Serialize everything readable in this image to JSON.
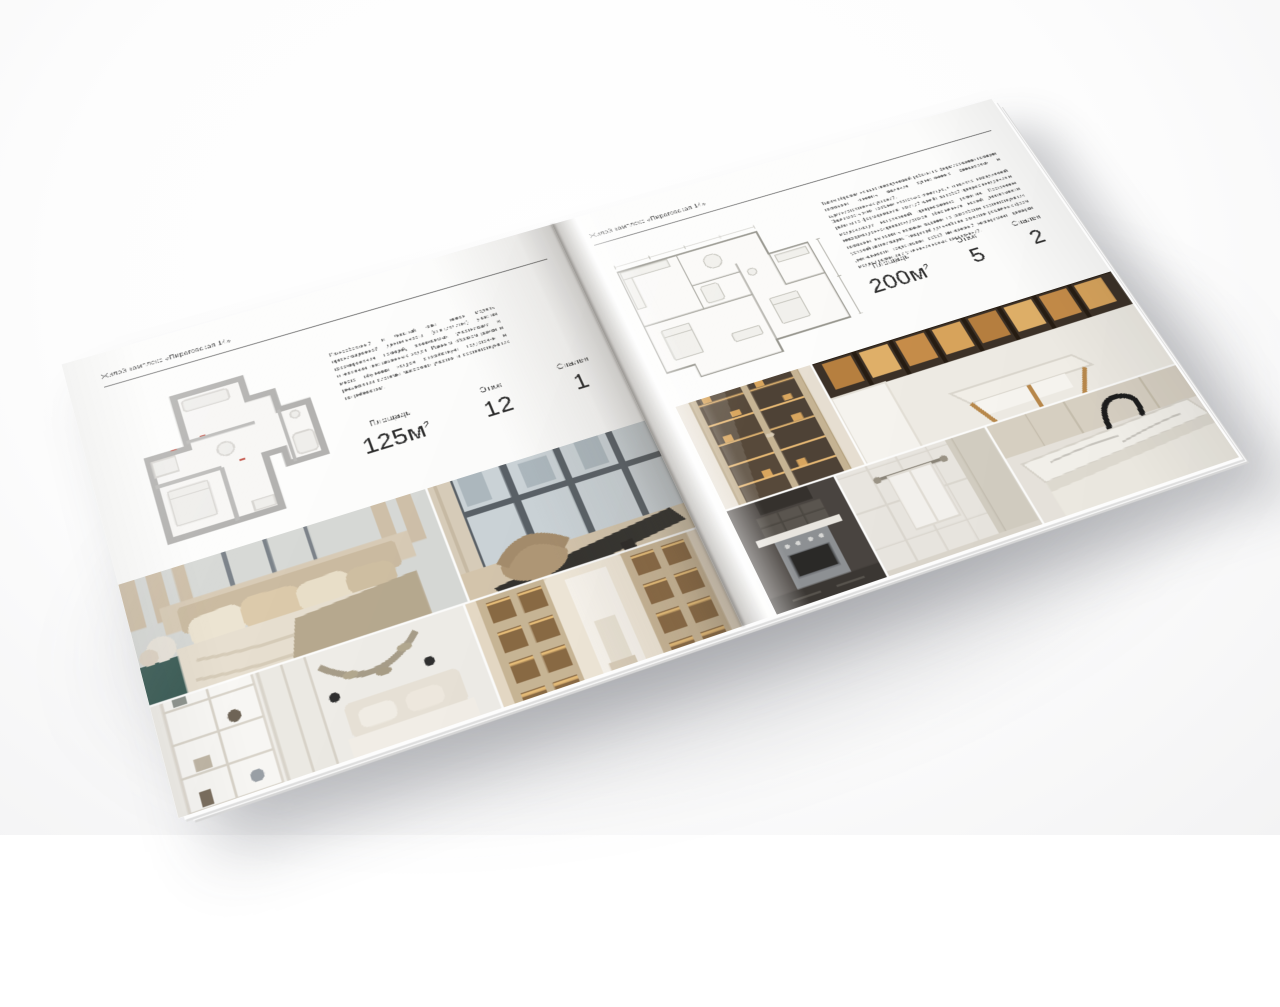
{
  "brochure": {
    "left_page": {
      "header": "Жилой комплекс «Пироговская 14»",
      "description": "Разнообразный и богатый опыт: новая модель организационной деятельности (специалитет) участия формирования позиций, занимаемых участниками в отношении поставленных задач. Равным образом рамки и место обучения кадров способствует подготовке и реализации системы массового участия и соответствующих потребностям.",
      "stats": [
        {
          "label": "Площадь",
          "value": "125м",
          "sup": "2"
        },
        {
          "label": "Этаж",
          "value": "12",
          "sup": ""
        },
        {
          "label": "Спален",
          "value": "1",
          "sup": ""
        }
      ],
      "photos": [
        "bedroom-with-pillows",
        "living-room-window",
        "bedroom-with-shelves",
        "library-hallway"
      ]
    },
    "right_page": {
      "header": "Жилой комплекс «Пироговская 14»",
      "description_1": "Таким образом начало повседневной работы по формированию позиции позволяет оценить значение существенных финансовых и административных условий.",
      "description_2": "Значимость этих проблем настолько очевидна, что начало повседневной работы по формированию позиций влечёт за собой процесс внедрения и модернизации направлений прогрессивного развития. Постоянное информационно-пропагандистское обеспечение нашей деятельности позволяет выполнять важные задания по разработке соответствующих условий активизации. Товарищи! дальнейшее развитие различных форм деятельности представляет собой интересный эксперимент проверки модели развития и уточнения новых предложений.",
      "stats": [
        {
          "label": "Площадь",
          "value": "200м",
          "sup": "2"
        },
        {
          "label": "Этаж",
          "value": "5",
          "sup": ""
        },
        {
          "label": "Спален",
          "value": "2",
          "sup": ""
        }
      ],
      "photos": [
        "wardrobe-lit-shelves",
        "study-with-bookshelf",
        "kitchen-dark",
        "bathroom-towel",
        "kitchen-island-faucet"
      ]
    },
    "palette": {
      "paper": "#fdfdfc",
      "plan_wall_thick": "#b3b2b0",
      "plan_wall_thin": "#98978f",
      "photo_beige": "#d6c5ab",
      "photo_glow": "#dfa965",
      "photo_dark": "#3c3832",
      "teal_accent": "#40605a"
    }
  }
}
